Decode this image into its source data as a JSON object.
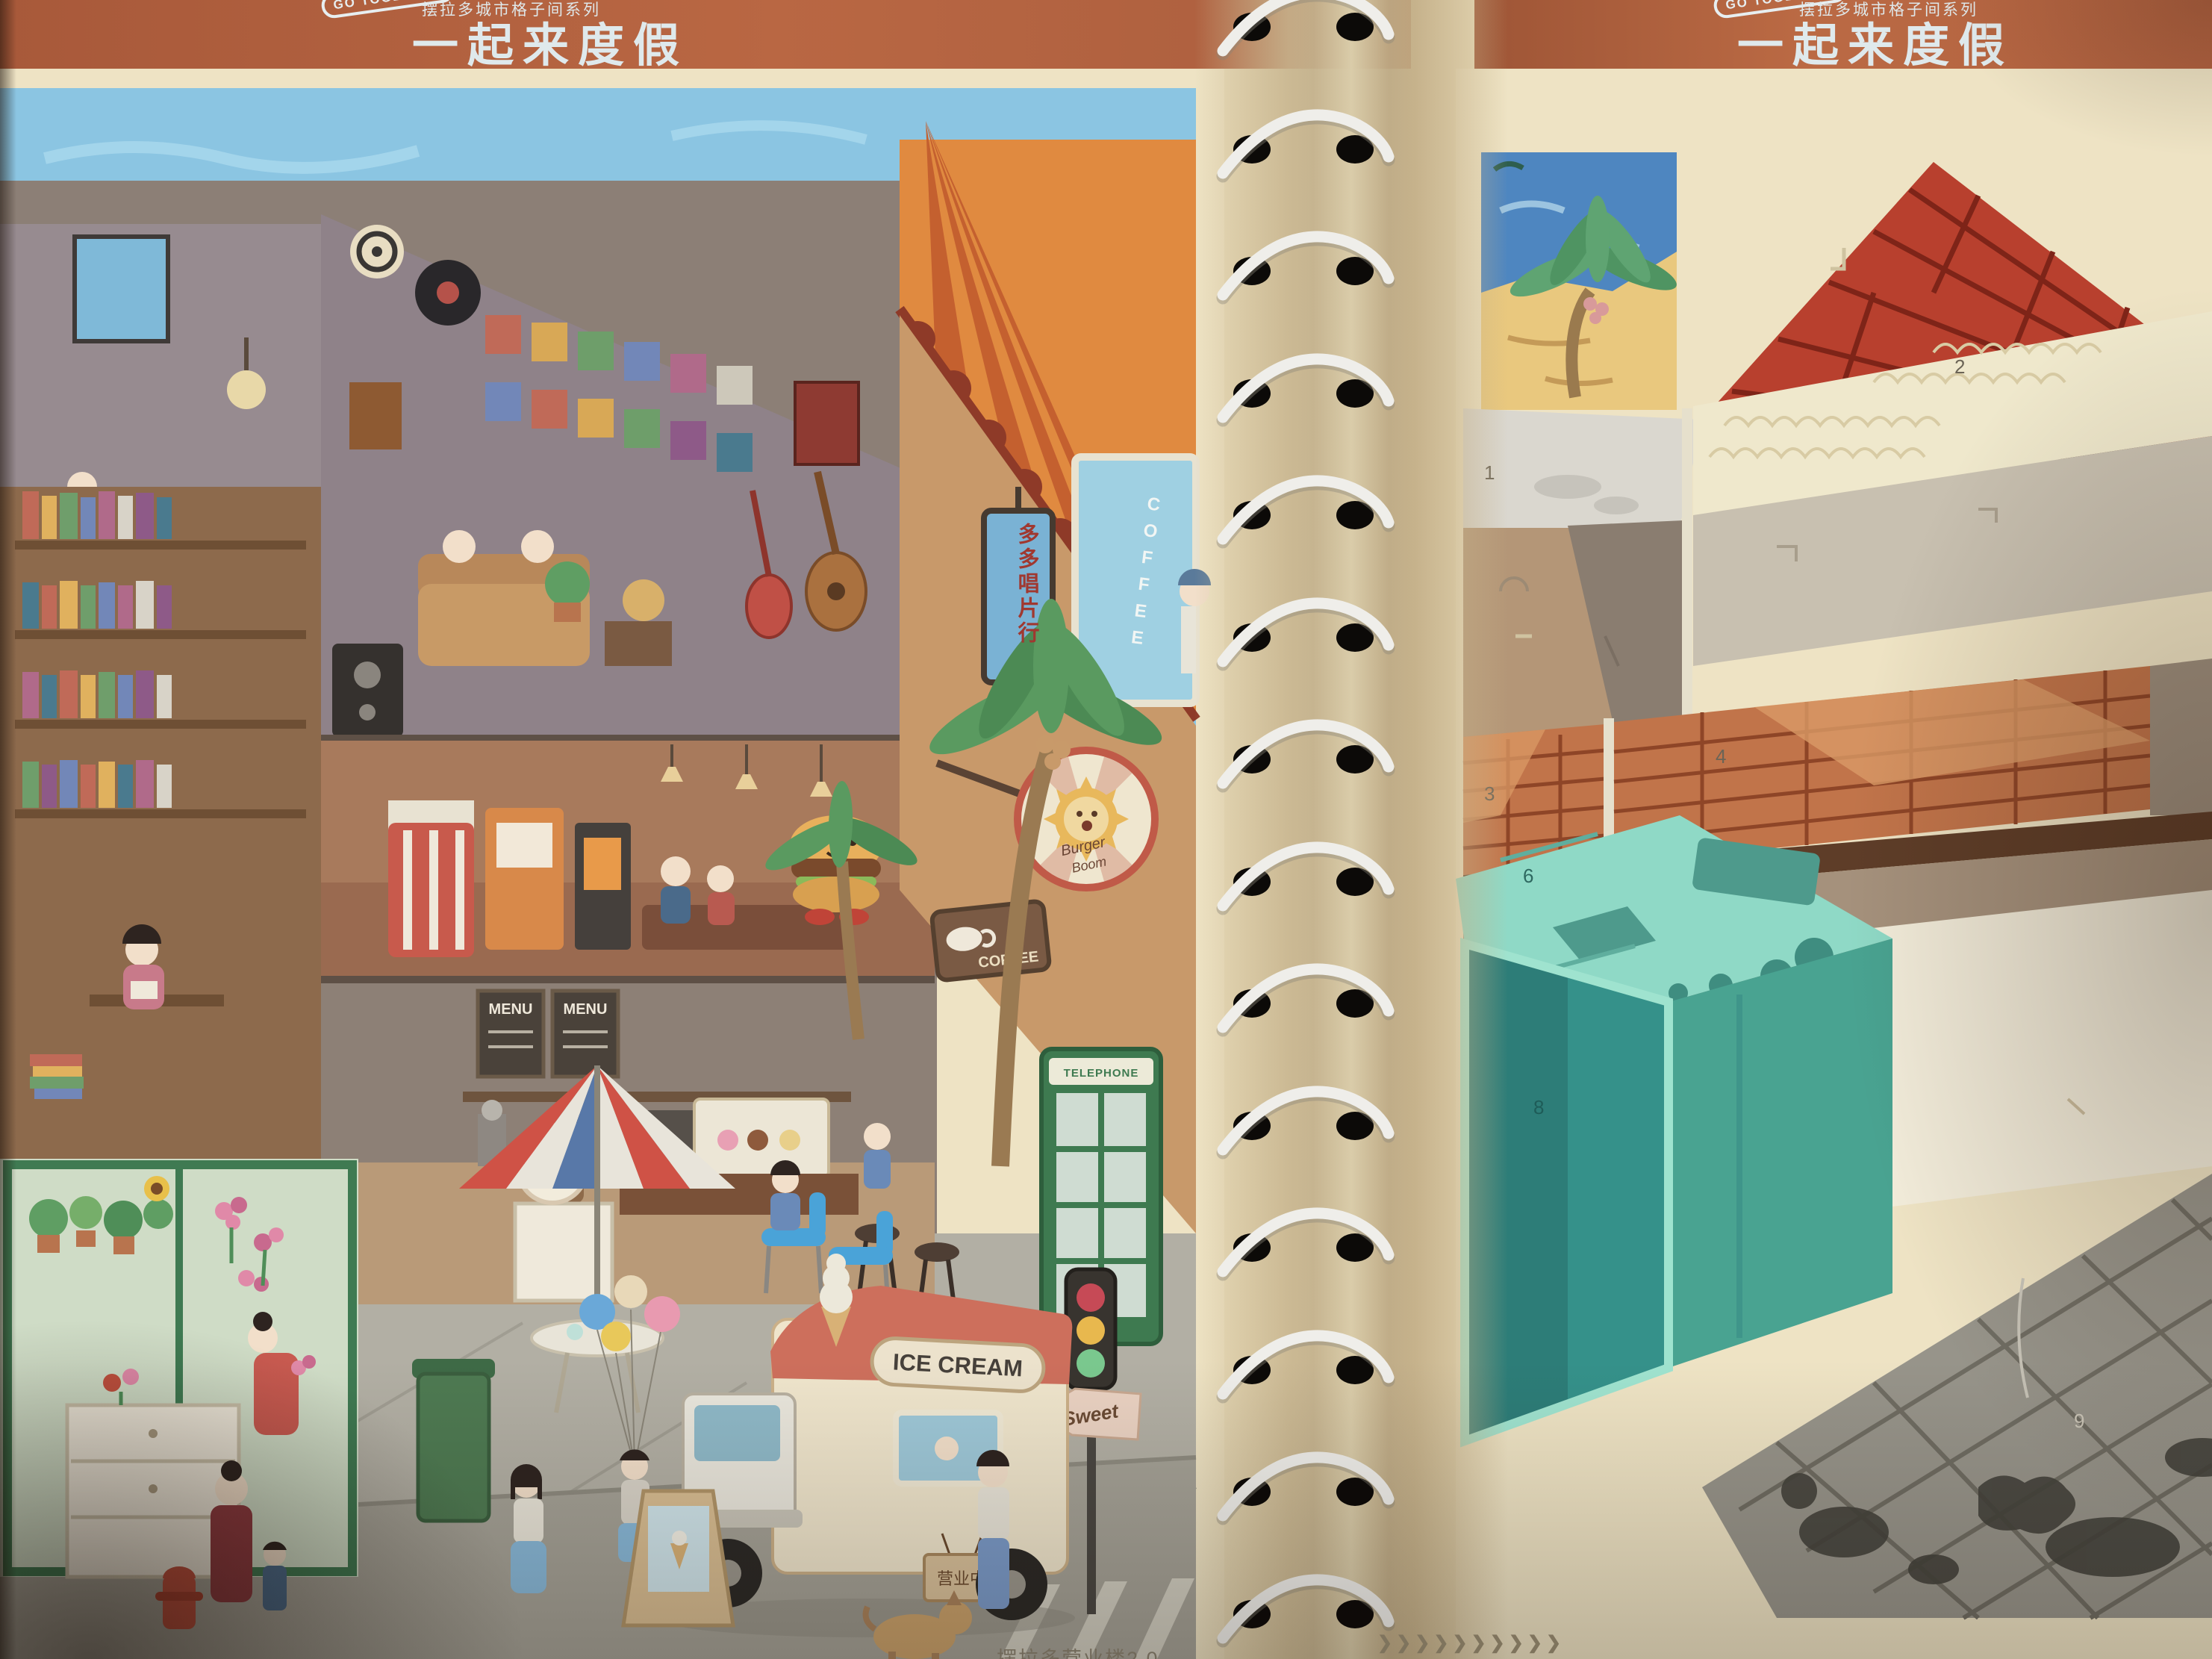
{
  "book": {
    "left_page": {
      "header": {
        "badge": "GO TOGETHER",
        "series": "摆拉多城市格子间系列",
        "title": "一起来度假"
      },
      "signs": {
        "record_shop": "多多唱片行",
        "window_coffee": "COFFEE",
        "sun_sign_top": "Burger",
        "sun_sign_bottom": "Boom",
        "coffee_plaque": "COFFEE",
        "menu_left": "MENU",
        "menu_right": "MENU",
        "flower_shop": "花花小屋",
        "telephone": "TELEPHONE",
        "truck": "ICE CREAM",
        "street_arrow": "Sweet",
        "open_sign": "营业中"
      },
      "footer": "摆拉多营业楼2.0"
    },
    "right_page": {
      "header": {
        "badge": "GO TOGETHER",
        "series": "摆拉多城市格子间系列",
        "title": "一起来度假"
      },
      "zones": [
        "1",
        "2",
        "3",
        "4",
        "5",
        "6",
        "8",
        "9"
      ],
      "chevrons": "❯❯❯❯❯❯❯❯❯❯"
    },
    "colors": {
      "header_orange": "#b5663f",
      "title_text": "#dfe9ec",
      "page_cream": "#eee3c4",
      "roof_red": "#b8402e",
      "awning_orange": "#e08a40",
      "teal_box": "#8fd9c6"
    }
  }
}
